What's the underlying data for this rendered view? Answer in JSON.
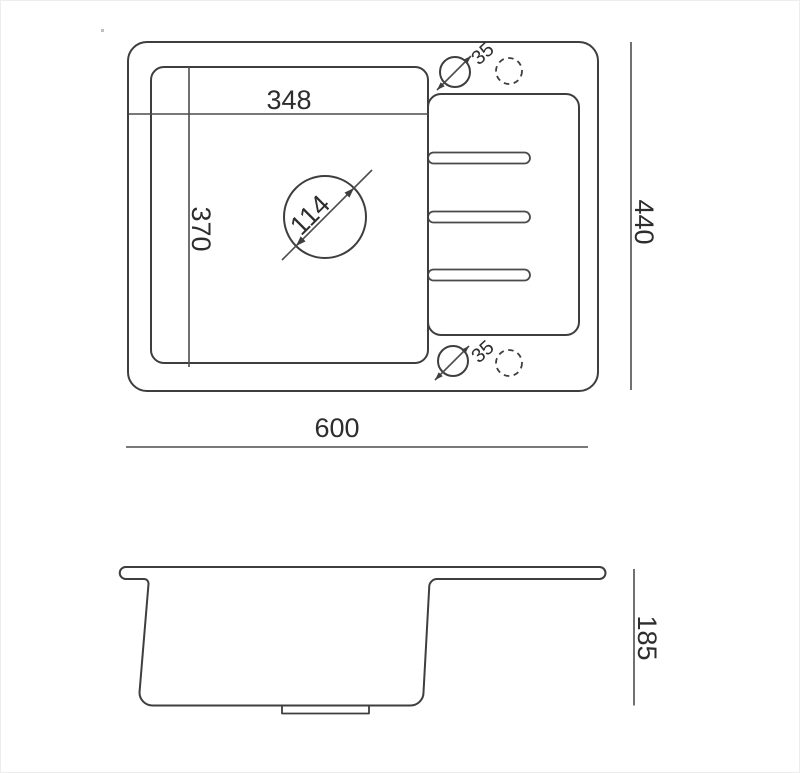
{
  "meta": {
    "drawing_type": "technical-dimension-drawing",
    "subject": "kitchen sink with drainboard, top view and side profile"
  },
  "colors": {
    "background": "#ffffff",
    "outline": "#3e3e3e",
    "dimension_line": "#4d4d4d",
    "text": "#2d2d2d"
  },
  "top_view": {
    "bowl_width_label": "348",
    "bowl_depth_label": "370",
    "drain_diameter_label": "114",
    "tap_hole_top_label": "35",
    "tap_hole_bottom_label": "35",
    "overall_width_label": "600",
    "overall_depth_label": "440"
  },
  "side_view": {
    "height_label": "185"
  }
}
